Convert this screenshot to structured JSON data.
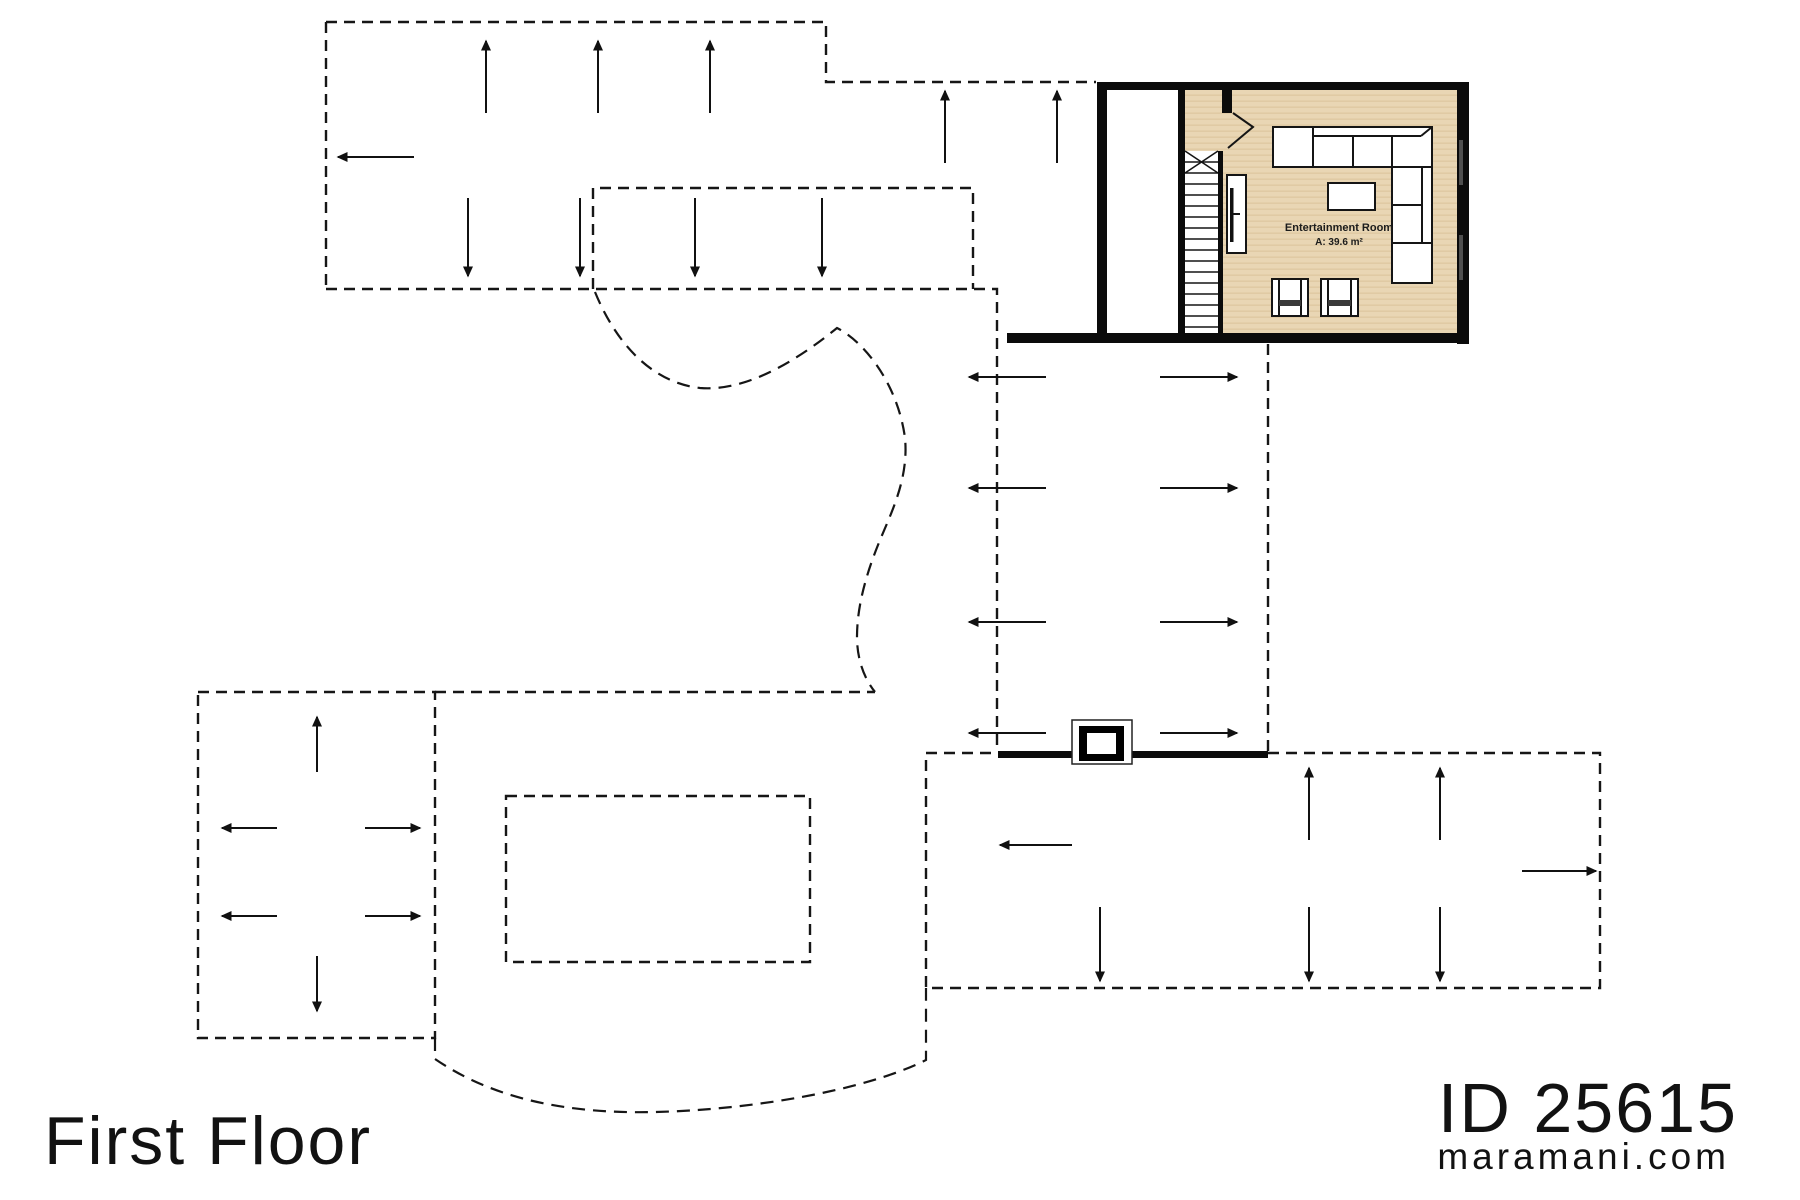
{
  "title_block": {
    "floor_label": "First Floor"
  },
  "branding": {
    "plan_id": "ID 25615",
    "website": "maramani.com"
  },
  "room": {
    "name": "Entertainment Room",
    "area_label": "A: 39.6 m²"
  },
  "colors": {
    "background": "#ffffff",
    "wall": "#0b0b0b",
    "outline": "#161616",
    "floor_base": "#e9d6b4",
    "floor_grain": "#dcc59d",
    "window_glass": "#4f4f4f",
    "furniture_fill": "#ffffff",
    "chair_cushion": "#3a3a3a"
  },
  "symbols": {
    "slope_arrow": "roof-slope-direction-arrow",
    "dashed_outline": "roof-overhang-outline",
    "stairs": "staircase-down",
    "chimney": "chimney-flue"
  }
}
